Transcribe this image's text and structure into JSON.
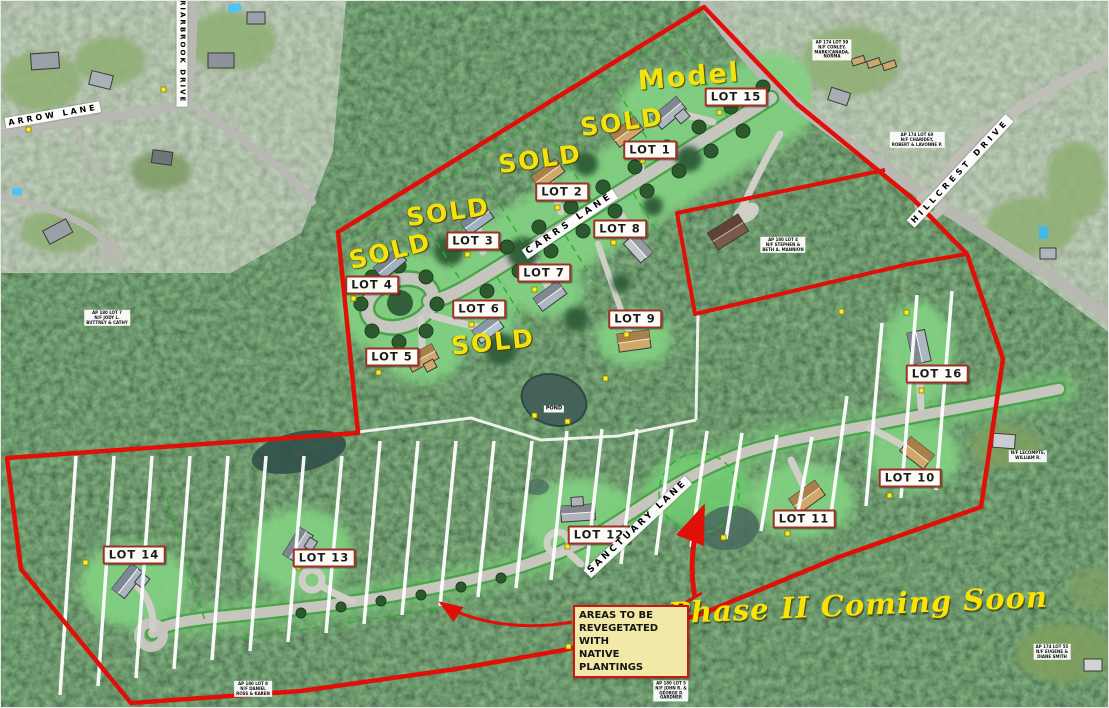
{
  "phase1": {
    "model": "Model",
    "sold": "SOLD",
    "lots": [
      "LOT 1",
      "LOT 2",
      "LOT 3",
      "LOT 4",
      "LOT 5",
      "LOT 6",
      "LOT 7",
      "LOT 8",
      "LOT 9",
      "LOT 15"
    ]
  },
  "phase2": {
    "coming_soon": "Phase II Coming Soon",
    "lots": [
      "LOT 10",
      "LOT 11",
      "LOT 12",
      "LOT 13",
      "LOT 14",
      "LOT 16"
    ],
    "note": "AREAS TO BE\nREVEGETATED WITH\nNATIVE PLANTINGS"
  },
  "streets": {
    "arrow_lane": "ARROW LANE",
    "briarbrook_drive": "BRIARBROOK DRIVE",
    "hillcrest_drive": "HILLCREST DRIVE",
    "carrs_lane": "CARRS LANE",
    "sanctuary_lane": "SANCTUARY LANE"
  },
  "pond": "POND",
  "parcels": [
    "AP 174 LOT 60\nN/F CHARIDEY,\nROBERT & LAVONNE P.",
    "AP 174 LOT 59\nN/F CONLEY,\nMARK/CANADA,\nNORMA",
    "AP 180 LOT 4\nN/F STEPHEN &\nBETH A. MANNION",
    "AP 180 LOT 7\nN/F JODY L.\nBUTTREY & CATHY",
    "AP 180 LOT 5\nN/F JOHN R. &\nGEORGE P.\nGARDNER",
    "AP 180 LOT 8\nN/F DANIEL\nROSS & KAREN",
    "N/F LECOMPTE,\nWILLIAM R.",
    "AP 174 LOT 55\nN/F EUGENE &\nDIANE SMITH"
  ],
  "colors": {
    "boundary": "#e01008",
    "sold_text": "#f2e30c",
    "clearing": "#82d182",
    "road": "#c6c6bf",
    "note_bg": "#f2e9a8"
  }
}
